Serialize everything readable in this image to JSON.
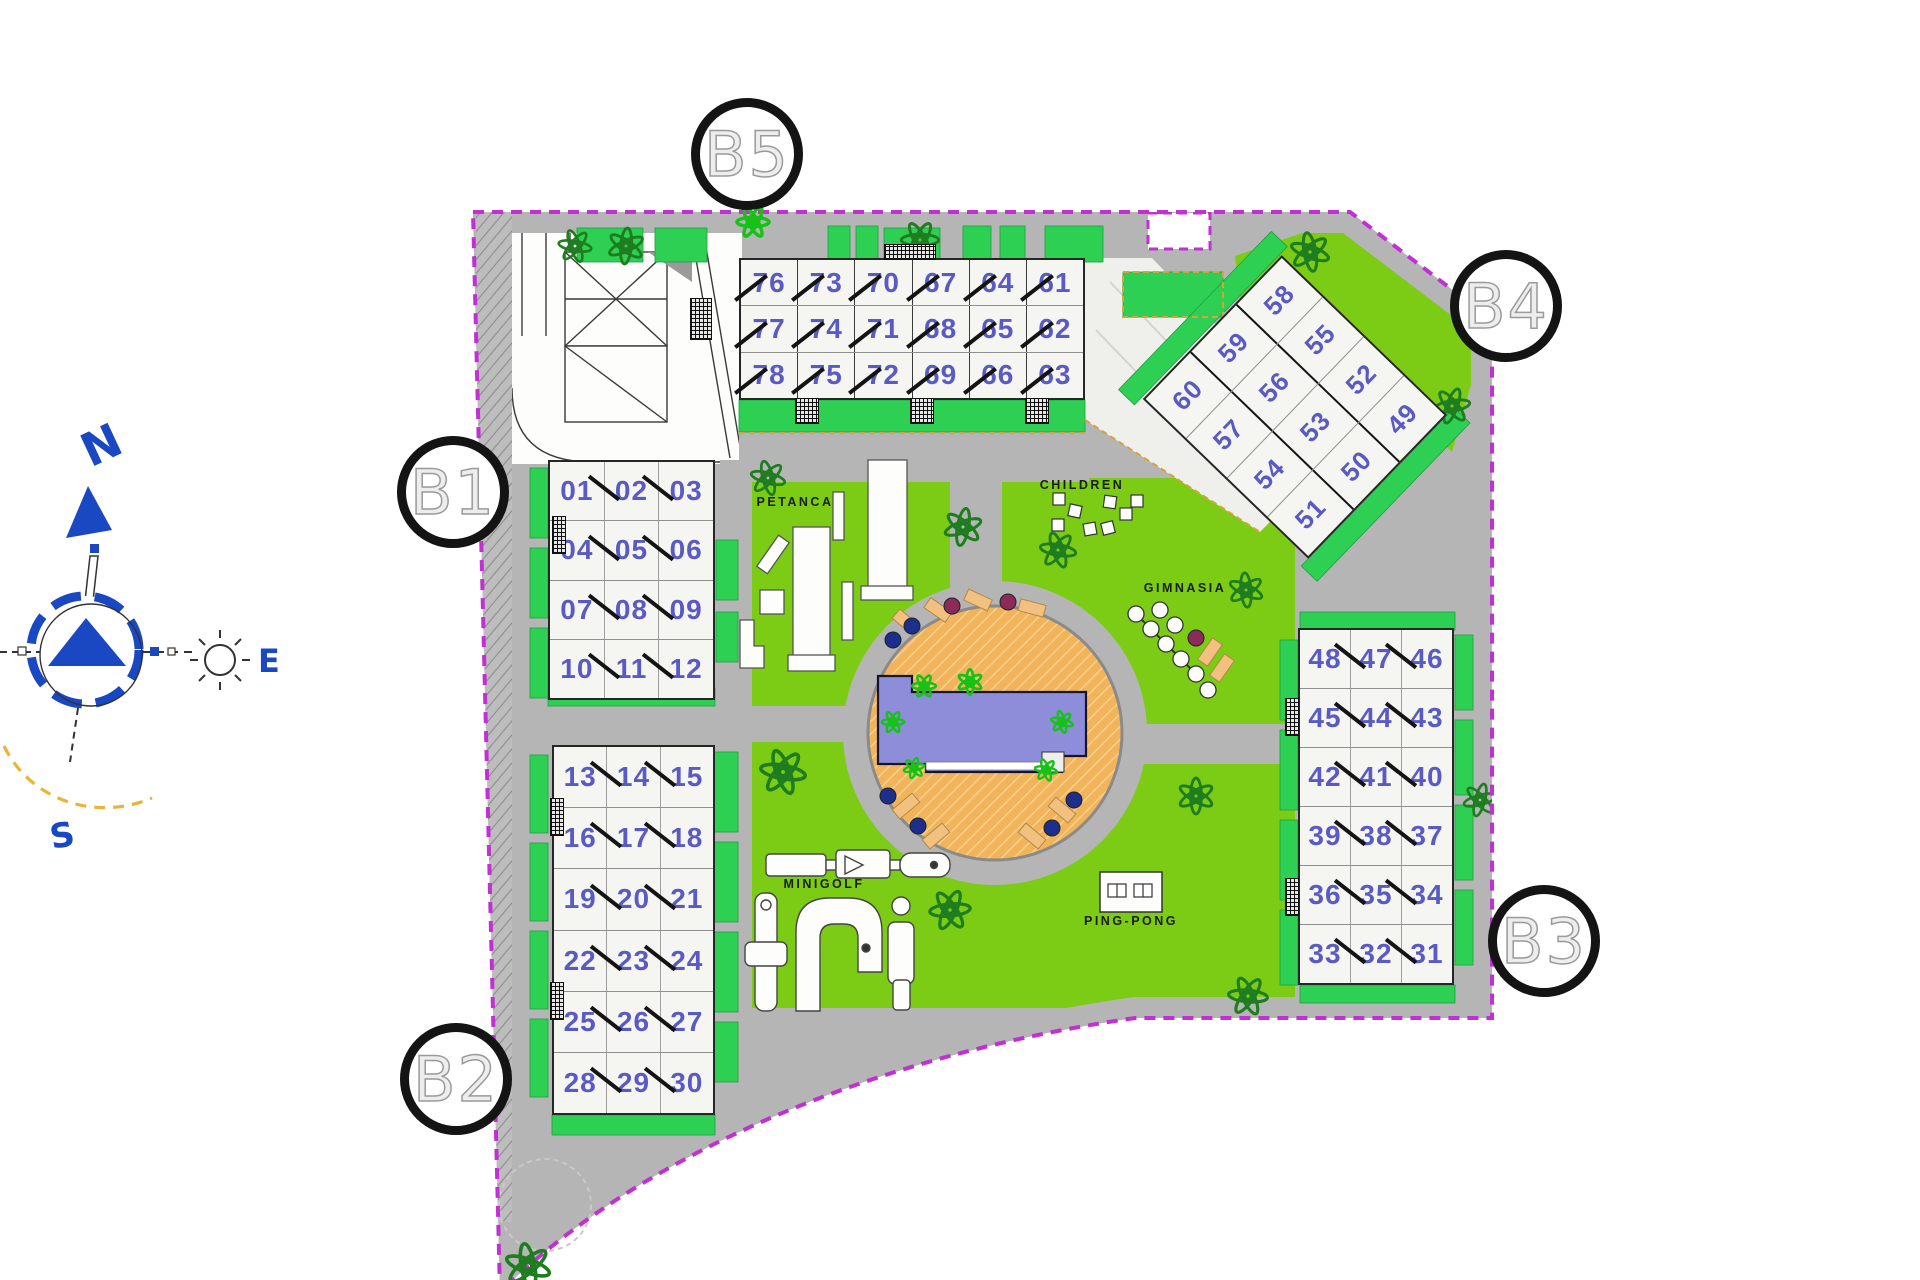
{
  "plan": {
    "markers": {
      "b1": "B1",
      "b2": "B2",
      "b3": "B3",
      "b4": "B4",
      "b5": "B5"
    },
    "compass": {
      "north": "N",
      "south": "S",
      "east": "E"
    },
    "buildings": {
      "b5_top": {
        "rows": [
          [
            "76",
            "73",
            "70",
            "67",
            "64",
            "61"
          ],
          [
            "77",
            "74",
            "71",
            "68",
            "65",
            "62"
          ],
          [
            "78",
            "75",
            "72",
            "69",
            "66",
            "63"
          ]
        ]
      },
      "b1_left_upper": {
        "rows": [
          [
            "01",
            "02",
            "03"
          ],
          [
            "04",
            "05",
            "06"
          ],
          [
            "07",
            "08",
            "09"
          ],
          [
            "10",
            "11",
            "12"
          ]
        ]
      },
      "b2_left_lower": {
        "rows": [
          [
            "13",
            "14",
            "15"
          ],
          [
            "16",
            "17",
            "18"
          ],
          [
            "19",
            "20",
            "21"
          ],
          [
            "22",
            "23",
            "24"
          ],
          [
            "25",
            "26",
            "27"
          ],
          [
            "28",
            "29",
            "30"
          ]
        ]
      },
      "b3_right": {
        "rows": [
          [
            "48",
            "47",
            "46"
          ],
          [
            "45",
            "44",
            "43"
          ],
          [
            "42",
            "41",
            "40"
          ],
          [
            "39",
            "38",
            "37"
          ],
          [
            "36",
            "35",
            "34"
          ],
          [
            "33",
            "32",
            "31"
          ]
        ]
      },
      "b4_diagonal": {
        "rows": [
          [
            "60",
            "59",
            "58"
          ],
          [
            "57",
            "56",
            "55"
          ],
          [
            "54",
            "53",
            "52"
          ],
          [
            "51",
            "50",
            "49"
          ]
        ]
      }
    },
    "amenities": {
      "petanca": "PETANCA",
      "children": "CHILDREN",
      "gimnasia": "GIMNASIA",
      "minigolf": "MINIGOLF",
      "ping_pong": "PING-PONG"
    },
    "colors": {
      "boundary": "#c22fd4",
      "lawn": "#7ccb15",
      "garden": "#2ed054",
      "path": "#b5b5b5",
      "building": "#f5f5f2",
      "unit_number": "#5a5ac4",
      "pool_water": "#8d8dda",
      "pool_deck": "#f2b45a",
      "tree": "#1e7d1e",
      "palm": "#17c217",
      "compass_blue": "#1a47c2",
      "marker_ring": "#141414",
      "accent_dash": "#d9a23c"
    }
  }
}
